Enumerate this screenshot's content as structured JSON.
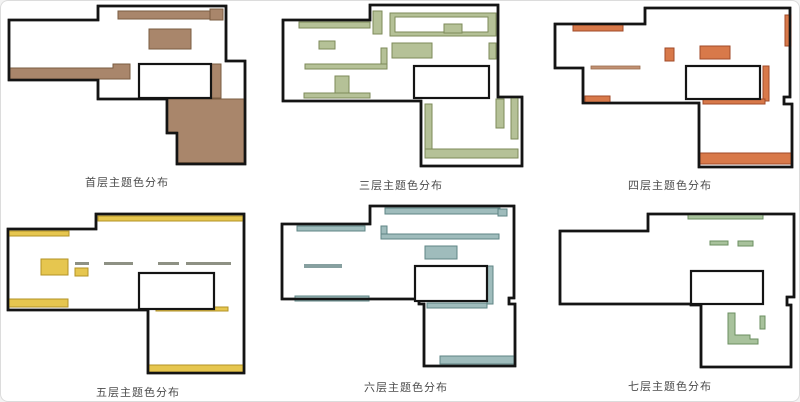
{
  "page": {
    "background": "#ffffff",
    "border": "#dcdcdc",
    "wall_color": "#141414",
    "caption_color": "#4c4c4c"
  },
  "accent_bars": {
    "neutral": "#8e9184",
    "tan": "#c29274",
    "tan_edge": "#9a6b4c",
    "teal": "#87a0a0"
  },
  "floors": [
    {
      "id": "ground",
      "label": "首层主题色分布",
      "color": "#a9866b",
      "border": "#7a5c42"
    },
    {
      "id": "third",
      "label": "三层主题色分布",
      "color": "#b5c197",
      "border": "#7d8a5a"
    },
    {
      "id": "fourth",
      "label": "四层主题色分布",
      "color": "#d8794a",
      "border": "#a04a28"
    },
    {
      "id": "fifth",
      "label": "五层主题色分布",
      "color": "#e6c64f",
      "border": "#b39325"
    },
    {
      "id": "sixth",
      "label": "六层主题色分布",
      "color": "#9fbcbc",
      "border": "#5f8585"
    },
    {
      "id": "seventh",
      "label": "七层主题色分布",
      "color": "#a8c29c",
      "border": "#6b8f60"
    }
  ]
}
